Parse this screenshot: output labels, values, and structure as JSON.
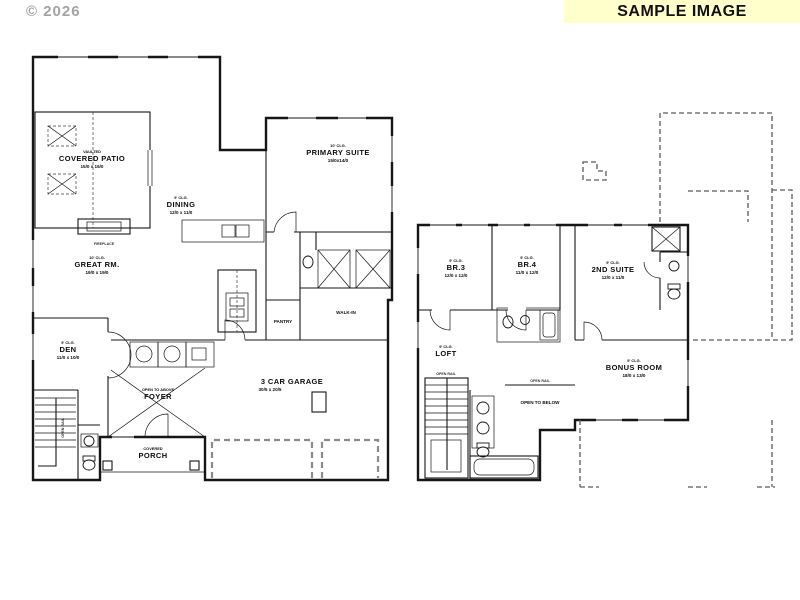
{
  "header": {
    "copyright": "© 2026",
    "banner": "SAMPLE IMAGE"
  },
  "colors": {
    "banner_bg": "#ffffcc",
    "ink": "#161616",
    "copyright_gray": "#a3a3a3"
  },
  "ff": {
    "covered_patio": {
      "note": "VAULTED",
      "name": "COVERED PATIO",
      "dims": "15/0 x 16/0"
    },
    "dining": {
      "note": "9' CLG.",
      "name": "DINING",
      "dims": "12/0 x 11/0"
    },
    "primary_suite": {
      "note": "10' CLG.",
      "name": "PRIMARY SUITE",
      "dims": "15/0x14/0"
    },
    "great_rm": {
      "note": "10' CLG.",
      "name": "GREAT RM.",
      "dims": "19/0 x 19/0"
    },
    "den": {
      "note": "9' CLG.",
      "name": "DEN",
      "dims": "11/0 x 10/0"
    },
    "garage": {
      "name": "3 CAR GARAGE",
      "dims": "30/5 x 20/5"
    },
    "foyer": {
      "note": "OPEN TO ABOVE",
      "name": "FOYER"
    },
    "porch": {
      "note": "COVERED",
      "name": "PORCH"
    },
    "pantry": {
      "name": "PANTRY"
    },
    "walk_in": {
      "name": "WALK-IN"
    },
    "fireplace": {
      "name": "FIREPLACE"
    },
    "open_rail": {
      "name": "OPEN RAIL"
    }
  },
  "sf": {
    "br3": {
      "note": "9' CLG.",
      "name": "BR.3",
      "dims": "12/0 x 12/0"
    },
    "br4": {
      "note": "9' CLG.",
      "name": "BR.4",
      "dims": "11/0 x 12/0"
    },
    "suite2": {
      "note": "9' CLG.",
      "name": "2ND SUITE",
      "dims": "12/0 x 11/0"
    },
    "loft": {
      "note": "9' CLG.",
      "name": "LOFT"
    },
    "bonus": {
      "note": "9' CLG.",
      "name": "BONUS ROOM",
      "dims": "18/0 x 13/0"
    },
    "open_below": {
      "name": "OPEN TO BELOW"
    },
    "open_rail": {
      "name": "OPEN RAIL"
    }
  }
}
